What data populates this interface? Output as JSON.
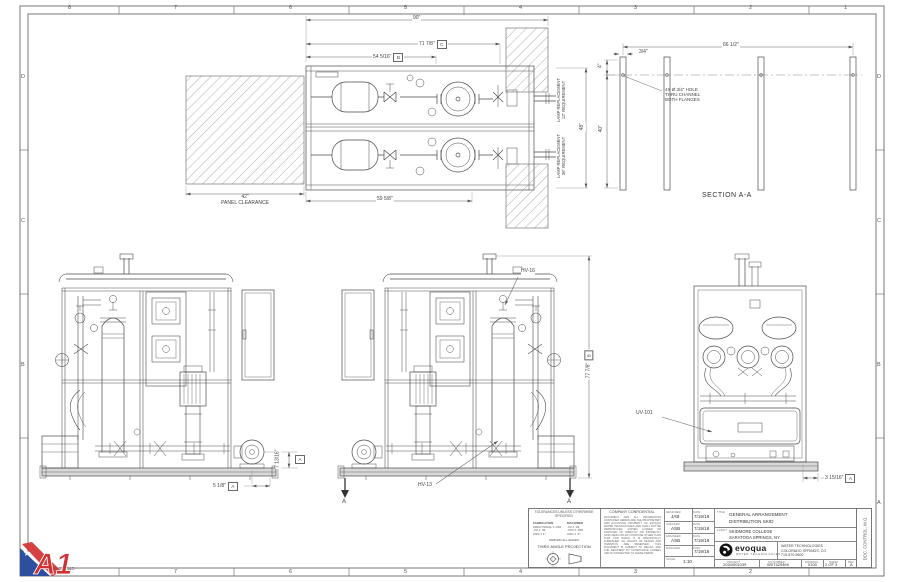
{
  "sheet": {
    "zones_top": [
      "8",
      "7",
      "6",
      "5",
      "4",
      "3",
      "2",
      "1"
    ],
    "zones_side": [
      "D",
      "C",
      "B",
      "A"
    ],
    "doc_control": "DOC. CONTROL, W.O.",
    "file_label": "2034001039_22X34D",
    "watermark": "A1"
  },
  "plan": {
    "dim_overall": "90\"",
    "dim_c": "71 7/8\"",
    "ref_c": "C",
    "dim_b": "54 5/16\"",
    "ref_b": "B",
    "dim_bottom": "59 5/8\"",
    "dim_depth": "48\"",
    "clearance_value": "42\"",
    "clearance_label": "PANEL CLEARANCE",
    "lamp_top_l1": "LAMP REPLACEMENT",
    "lamp_top_l2": "12\" REQUIREMENT",
    "lamp_bot_l1": "LAMP REPLACEMENT",
    "lamp_bot_l2": "36\" REQUIREMENT"
  },
  "section": {
    "title": "SECTION A-A",
    "dim_width": "66 1/2\"",
    "dim_flange": "3/4\"",
    "dim_hole": "4\"",
    "dim_height": "40\"",
    "note_l1": "4X  Ø.3/4\" HOLE",
    "note_l2": "THRU CHANNEL",
    "note_l3": "BOTH FLANGES"
  },
  "elev1": {
    "dim_h": "7 13/16\"",
    "ref": "A",
    "dim_w": "5 1/8\""
  },
  "elev2": {
    "hv16": "HV-16",
    "hv13": "HV-13",
    "dim_h": "77 7/8\"",
    "ref": "B",
    "arrow_l": "A",
    "arrow_r": "A"
  },
  "endview": {
    "tag": "UV-101",
    "dim": "3 15/16\"",
    "ref": "A"
  },
  "titleblock": {
    "tol_header": "TOLERANCES UNLESS OTHERWISE SPECIFIED",
    "tol_col1_h": "FABRICATION",
    "tol_col1": "FRACTIONAL ± 1/16\n.XX ± .06\nANG ± 1°",
    "tol_col2_h": "MACHINED",
    "tol_col2": ".XX ± .03\n.XXX ± .005\nANG ± .5°",
    "tol_note": "DEBURR ALL EDGES",
    "projection": "THIRD ANGLE PROJECTION",
    "confidential_header": "COMPANY CONFIDENTIAL",
    "confidential_body": "DOCUMENT AND ALL INFORMATION CONTAINED HEREIN ARE THE PROPRIETARY AND EXCLUSIVE PROPERTY OF EVOQUA WATER TECHNOLOGIES AND SHALL NOT BE REPRODUCED, COPIED, LOANED OR DISPOSED OF DIRECTLY OR INDIRECTLY NOR USED FOR ANY PURPOSE OTHER THAN THAT FOR WHICH IT IS SPECIFICALLY FURNISHED. ALL RIGHTS OF DESIGN AND INVENTION ARE RESERVED. THIS DOCUMENT IS SUBJECT TO RECALL AND THE RECIPIENT BY ACCEPTANCE AGREES AND IS CONNECTED TO THESE TERMS.",
    "roles": [
      {
        "role": "DESIGNER",
        "name": "JAB",
        "date": "7/19/18"
      },
      {
        "role": "CHECKER",
        "name": "ASB",
        "date": "7/19/18"
      },
      {
        "role": "ENGINEER",
        "name": "ASB",
        "date": "7/19/18"
      },
      {
        "role": "MANAGER",
        "name": "",
        "date": "7/19/18"
      }
    ],
    "date_header": "DATE",
    "scale_label": "SCALE",
    "scale_value": "1:10",
    "title_label": "TITLE",
    "title_l1": "GENERAL ARRANGEMENT",
    "title_l2": "DISTRIBUTION SKID",
    "client_label": "CLIENT",
    "client_l1": "SKIDMORE COLLEGE",
    "client_l2": "SARATOGA SPRINGS, NY",
    "brand": "evoqua",
    "brand_sub": "WATER TECHNOLOGIES",
    "company_l1": "WATER TECHNOLOGIES",
    "company_l2": "COLORADO SPRINGS, CO",
    "company_l3": "719-570-9600",
    "project_label": "PROJECT",
    "project": "2034/001039",
    "ga_label": "GA NUMBER",
    "ga": "W0T429469",
    "drawing_label": "DRAWING",
    "drawing": "0100",
    "sheet_label": "SHEET",
    "sheet_num": "2",
    "sheet_of": "OF",
    "sheet_total": "3",
    "rev_label": "REV",
    "rev": "A"
  }
}
